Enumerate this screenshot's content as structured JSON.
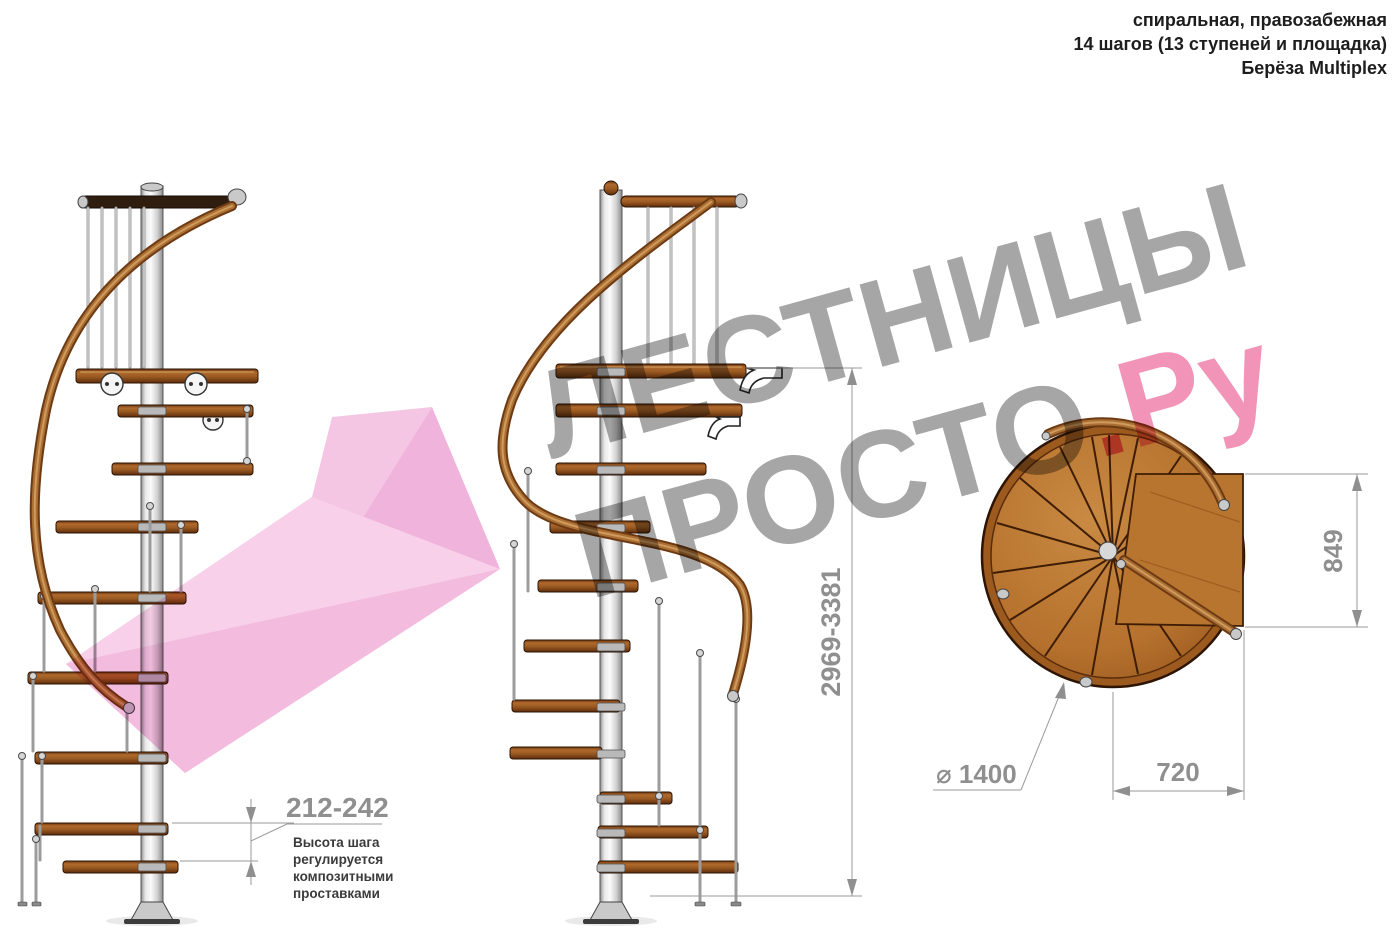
{
  "header": {
    "line1": "спиральная, правозабежная",
    "line2": "14 шагов (13 ступеней и площадка)",
    "line3": "Берёза Multiplex"
  },
  "watermark": {
    "word1": "ЛЕСТНИЦЫ",
    "word2": "ПРОСТО",
    "dot": ".",
    "suffix": "Ру",
    "gray_color": "#9f9f9f",
    "pink_color": "#f08cb2"
  },
  "dimensions": {
    "total_height": "2969-3381",
    "step_height": "212-242",
    "platform_depth": "849",
    "platform_width": "720",
    "diameter": "⌀ 1400"
  },
  "note": {
    "line1": "Высота шага",
    "line2": "регулируется",
    "line3": "композитными",
    "line4": "проставками"
  },
  "drawing": {
    "colors": {
      "wood": "#b5712d",
      "wood_dark": "#7a3c12",
      "handrail": "#9c5a22",
      "metal_pole": "#c9c9c9",
      "dimension_gray": "#8f8f8f",
      "watermark_pink": "#f08cb2",
      "arrow_pink": "#f3b7dd"
    }
  }
}
